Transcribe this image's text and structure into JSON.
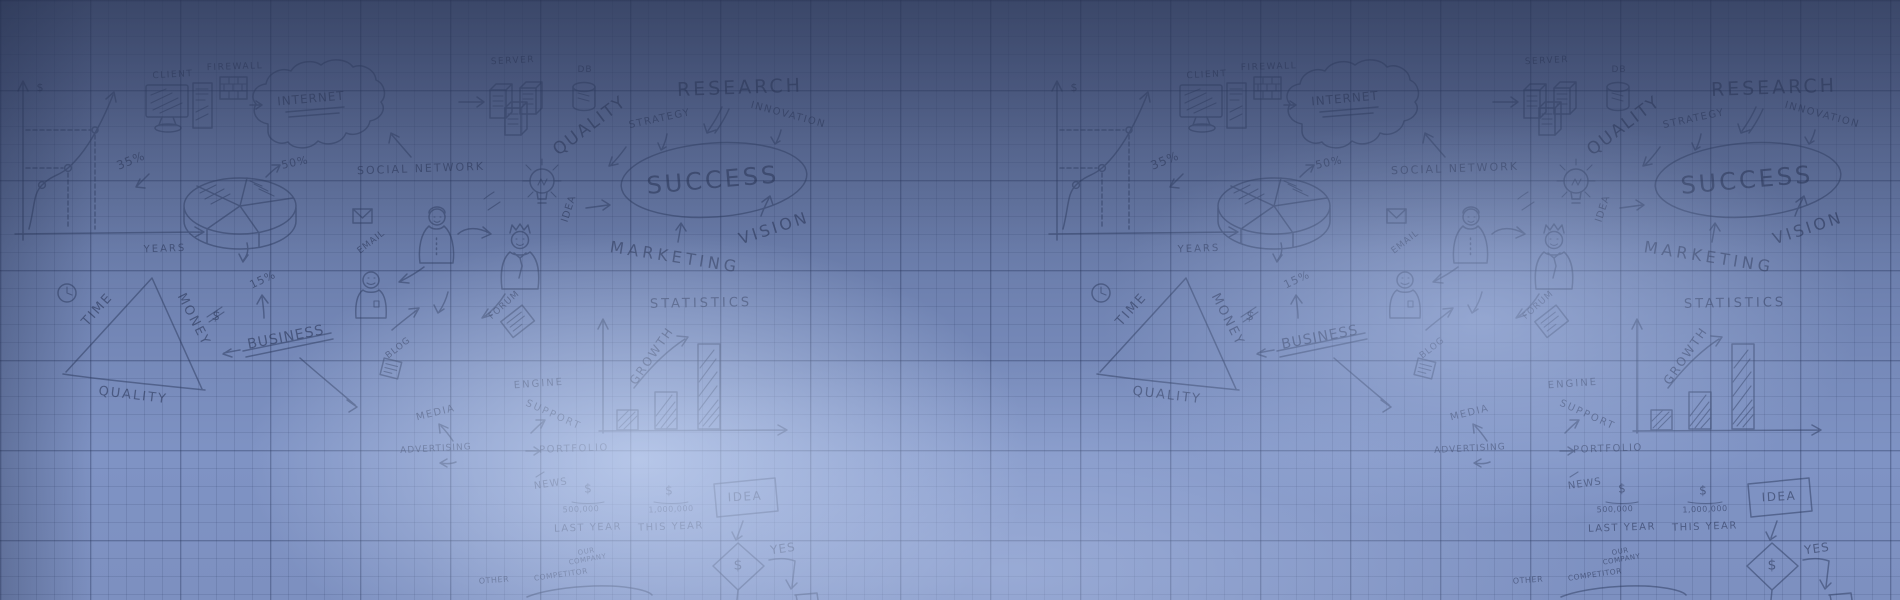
{
  "meta": {
    "kind": "business-doodle banner background",
    "tile_period_px": 1034
  },
  "palette": {
    "bg_top": "#4f5e86",
    "bg_bottom": "#7d90c0",
    "glow": "#d6e4fd",
    "ink": "#2c3a5e",
    "grid_line": "#263454"
  },
  "tiles": {
    "offsets": [
      0,
      1034
    ]
  },
  "labels": [
    {
      "id": "dollar-axis",
      "text": "$",
      "x": 40,
      "y": 88,
      "rot": 0,
      "size": 11,
      "ls": 0
    },
    {
      "id": "pct35",
      "text": "35%",
      "x": 131,
      "y": 161,
      "rot": -22,
      "size": 12,
      "ls": 1
    },
    {
      "id": "years",
      "text": "YEARS",
      "x": 165,
      "y": 250,
      "rot": -2,
      "size": 10,
      "ls": 2
    },
    {
      "id": "client",
      "text": "CLIENT",
      "x": 173,
      "y": 76,
      "rot": -3,
      "size": 9,
      "ls": 1.5
    },
    {
      "id": "firewall",
      "text": "FIREWALL",
      "x": 235,
      "y": 68,
      "rot": -2,
      "size": 9,
      "ls": 1.5
    },
    {
      "id": "internet",
      "text": "INTERNET",
      "x": 311,
      "y": 99,
      "rot": -5,
      "size": 12,
      "ls": 1
    },
    {
      "id": "server",
      "text": "SERVER",
      "x": 513,
      "y": 62,
      "rot": -3,
      "size": 9,
      "ls": 1.5
    },
    {
      "id": "db",
      "text": "DB",
      "x": 585,
      "y": 71,
      "rot": 0,
      "size": 9,
      "ls": 1
    },
    {
      "id": "quality-big",
      "text": "QUALITY",
      "x": 590,
      "y": 126,
      "rot": -37,
      "size": 17,
      "ls": 2
    },
    {
      "id": "strategy",
      "text": "STRATEGY",
      "x": 660,
      "y": 120,
      "rot": -12,
      "size": 10,
      "ls": 1.5
    },
    {
      "id": "research",
      "text": "RESEARCH",
      "x": 740,
      "y": 88,
      "rot": -2,
      "size": 19,
      "ls": 3
    },
    {
      "id": "innovation",
      "text": "INNOVATION",
      "x": 788,
      "y": 116,
      "rot": 15,
      "size": 10,
      "ls": 1.5
    },
    {
      "id": "social-network",
      "text": "SOCIAL NETWORK",
      "x": 421,
      "y": 169,
      "rot": -2,
      "size": 11,
      "ls": 2
    },
    {
      "id": "pct50",
      "text": "50%",
      "x": 295,
      "y": 163,
      "rot": -12,
      "size": 11,
      "ls": 1
    },
    {
      "id": "success",
      "text": "SUCCESS",
      "x": 713,
      "y": 181,
      "rot": -5,
      "size": 24,
      "ls": 3
    },
    {
      "id": "vision",
      "text": "VISION",
      "x": 774,
      "y": 228,
      "rot": -18,
      "size": 16,
      "ls": 3
    },
    {
      "id": "marketing",
      "text": "MARKETING",
      "x": 675,
      "y": 257,
      "rot": 9,
      "size": 16,
      "ls": 4
    },
    {
      "id": "statistics",
      "text": "STATISTICS",
      "x": 701,
      "y": 304,
      "rot": -1,
      "size": 13,
      "ls": 3
    },
    {
      "id": "growth",
      "text": "GROWTH",
      "x": 652,
      "y": 356,
      "rot": -55,
      "size": 12,
      "ls": 2
    },
    {
      "id": "engine",
      "text": "ENGINE",
      "x": 539,
      "y": 385,
      "rot": -4,
      "size": 10,
      "ls": 2
    },
    {
      "id": "support",
      "text": "SUPPORT",
      "x": 553,
      "y": 416,
      "rot": 24,
      "size": 10,
      "ls": 2
    },
    {
      "id": "portfolio",
      "text": "PORTFOLIO",
      "x": 574,
      "y": 450,
      "rot": -2,
      "size": 10,
      "ls": 1.5
    },
    {
      "id": "news",
      "text": "NEWS",
      "x": 551,
      "y": 485,
      "rot": -8,
      "size": 10,
      "ls": 1
    },
    {
      "id": "media",
      "text": "MEDIA",
      "x": 436,
      "y": 414,
      "rot": -14,
      "size": 10,
      "ls": 1.5
    },
    {
      "id": "advertising",
      "text": "ADVERTISING",
      "x": 436,
      "y": 450,
      "rot": -3,
      "size": 9,
      "ls": 1
    },
    {
      "id": "blog",
      "text": "BLOG",
      "x": 399,
      "y": 349,
      "rot": -38,
      "size": 9,
      "ls": 1
    },
    {
      "id": "forum",
      "text": "FORUM",
      "x": 505,
      "y": 306,
      "rot": -42,
      "size": 9,
      "ls": 1
    },
    {
      "id": "email",
      "text": "EMAIL",
      "x": 372,
      "y": 243,
      "rot": -38,
      "size": 9,
      "ls": 1
    },
    {
      "id": "idea-vertical",
      "text": "IDEA",
      "x": 570,
      "y": 209,
      "rot": -72,
      "size": 10,
      "ls": 1
    },
    {
      "id": "time",
      "text": "TIME",
      "x": 98,
      "y": 310,
      "rot": -48,
      "size": 13,
      "ls": 2
    },
    {
      "id": "money",
      "text": "MONEY",
      "x": 193,
      "y": 320,
      "rot": 63,
      "size": 13,
      "ls": 2
    },
    {
      "id": "quality-triangle",
      "text": "QUALITY",
      "x": 133,
      "y": 396,
      "rot": 7,
      "size": 13,
      "ls": 2
    },
    {
      "id": "dollar-crossed",
      "text": "$",
      "x": 216,
      "y": 317,
      "rot": 10,
      "size": 13,
      "ls": 0
    },
    {
      "id": "pct15",
      "text": "15%",
      "x": 263,
      "y": 280,
      "rot": -25,
      "size": 11,
      "ls": 1
    },
    {
      "id": "business",
      "text": "BUSINESS",
      "x": 286,
      "y": 338,
      "rot": -11,
      "size": 14,
      "ls": 1
    },
    {
      "id": "dollar-last",
      "text": "$",
      "x": 588,
      "y": 489,
      "rot": 0,
      "size": 12,
      "ls": 0
    },
    {
      "id": "amount-last",
      "text": "500,000",
      "x": 581,
      "y": 510,
      "rot": -2,
      "size": 8,
      "ls": 0.5
    },
    {
      "id": "last-year",
      "text": "LAST YEAR",
      "x": 588,
      "y": 529,
      "rot": -2,
      "size": 10,
      "ls": 1.5
    },
    {
      "id": "dollar-this",
      "text": "$",
      "x": 669,
      "y": 491,
      "rot": 0,
      "size": 12,
      "ls": 0
    },
    {
      "id": "amount-this",
      "text": "1,000,000",
      "x": 671,
      "y": 510,
      "rot": -2,
      "size": 8,
      "ls": 0.5
    },
    {
      "id": "this-year",
      "text": "THIS YEAR",
      "x": 671,
      "y": 528,
      "rot": -2,
      "size": 10,
      "ls": 1.5
    },
    {
      "id": "idea-box",
      "text": "IDEA",
      "x": 745,
      "y": 497,
      "rot": -3,
      "size": 12,
      "ls": 1.5
    },
    {
      "id": "dollar-diamond",
      "text": "$",
      "x": 738,
      "y": 566,
      "rot": 0,
      "size": 14,
      "ls": 0
    },
    {
      "id": "yes",
      "text": "YES",
      "x": 783,
      "y": 549,
      "rot": -8,
      "size": 12,
      "ls": 1
    },
    {
      "id": "our-company",
      "text": "OUR\nCOMPANY",
      "x": 587,
      "y": 556,
      "rot": -10,
      "size": 7,
      "ls": 0.5
    },
    {
      "id": "competitor",
      "text": "COMPETITOR",
      "x": 561,
      "y": 575,
      "rot": -8,
      "size": 7.5,
      "ls": 0.5
    },
    {
      "id": "other",
      "text": "OTHER",
      "x": 494,
      "y": 581,
      "rot": -4,
      "size": 8,
      "ls": 0.5
    }
  ]
}
